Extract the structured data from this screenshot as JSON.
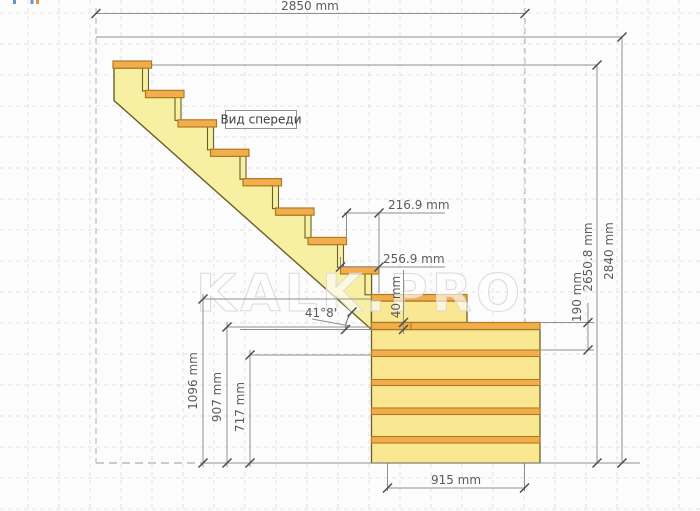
{
  "view_label": {
    "text": "Вид спереди"
  },
  "watermark": {
    "text": "KALK.PRO"
  },
  "dimensions": {
    "total_width": "2850 mm",
    "total_height": "2840 mm",
    "stringer_top_height": "2650.8 mm",
    "step_run": "216.9 mm",
    "tread_depth": "256.9 mm",
    "tread_thickness": "40 mm",
    "step_rise": "190 mm",
    "height_to_step9": "1096 mm",
    "height_to_platform_top": "907 mm",
    "height_to_board": "717 mm",
    "platform_width": "915 mm",
    "stair_angle": "41°8'"
  },
  "figure": {
    "type": "stair-front-elevation",
    "treads_on_stringer": 8,
    "platform_boards": 5,
    "colors": {
      "tread_fill": "#f2ad4c",
      "tread_stroke": "#b07a20",
      "stringer_fill": "#f7f0a2",
      "stringer_stroke": "#6a5f28",
      "platform_fill": "#f9e891",
      "dim_line": "#8f8f8f",
      "dim_tick": "#4c4c4c",
      "grid": "#e2e2e2"
    }
  },
  "artifacts": {
    "fragment_colors": [
      "#6a93c8",
      "#6a93c8",
      "#dc9a48"
    ]
  }
}
